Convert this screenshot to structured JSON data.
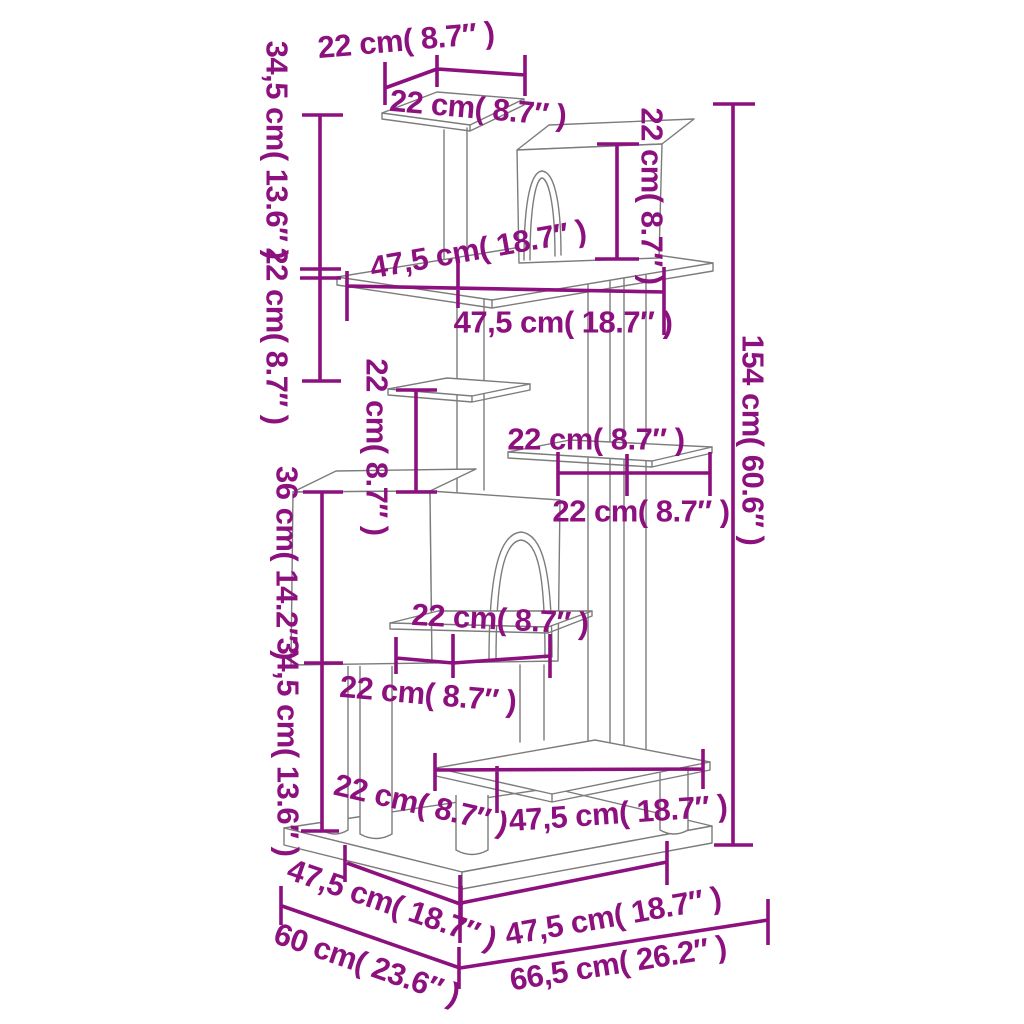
{
  "diagram": {
    "accent_color": "#8c117f",
    "line_color": "#7c7c7c",
    "background_color": "#ffffff",
    "labels": [
      {
        "id": "top-depth-22",
        "text": "22 cm( 8.7″ )",
        "x": 406,
        "y": 40,
        "rot": -5
      },
      {
        "id": "top-width-22",
        "text": "22 cm( 8.7″ )",
        "x": 478,
        "y": 108,
        "rot": 5
      },
      {
        "id": "left-upper-345",
        "text": "34,5 cm( 13.6″ )",
        "x": 277,
        "y": 150,
        "rot": 90
      },
      {
        "id": "left-upper-22",
        "text": "22 cm( 8.7″ )",
        "x": 277,
        "y": 336,
        "rot": 90
      },
      {
        "id": "house1-height-22",
        "text": "22 cm( 8.7″ )",
        "x": 652,
        "y": 196,
        "rot": 90
      },
      {
        "id": "total-height-154",
        "text": "154 cm( 60.6″ )",
        "x": 753,
        "y": 440,
        "rot": 90
      },
      {
        "id": "plat2-depth-475",
        "text": "47,5 cm( 18.7″ )",
        "x": 478,
        "y": 249,
        "rot": -10
      },
      {
        "id": "plat2-width-475",
        "text": "47,5 cm( 18.7″ )",
        "x": 563,
        "y": 322,
        "rot": 0
      },
      {
        "id": "gap-height-22",
        "text": "22 cm( 8.7″ )",
        "x": 377,
        "y": 447,
        "rot": 90
      },
      {
        "id": "shelfR-depth-22",
        "text": "22 cm( 8.7″ )",
        "x": 596,
        "y": 439,
        "rot": 0
      },
      {
        "id": "shelfR-width-22",
        "text": "22 cm( 8.7″ )",
        "x": 641,
        "y": 511,
        "rot": 0
      },
      {
        "id": "house2-height-36",
        "text": "36 cm( 14.2″ )",
        "x": 287,
        "y": 563,
        "rot": 90
      },
      {
        "id": "shelf5-depth-22",
        "text": "22 cm( 8.7″ )",
        "x": 500,
        "y": 619,
        "rot": 3
      },
      {
        "id": "left-lower-345",
        "text": "34,5 cm( 13.6″ )",
        "x": 288,
        "y": 747,
        "rot": 90
      },
      {
        "id": "shelf5-width-22",
        "text": "22 cm( 8.7″ )",
        "x": 428,
        "y": 694,
        "rot": 5
      },
      {
        "id": "base-left-22",
        "text": "22 cm( 8.7″ )",
        "x": 421,
        "y": 804,
        "rot": 13
      },
      {
        "id": "plat6-width-475",
        "text": "47,5 cm( 18.7″ )",
        "x": 618,
        "y": 813,
        "rot": -4
      },
      {
        "id": "baseL-depth-475",
        "text": "47,5 cm( 18.7″ )",
        "x": 392,
        "y": 904,
        "rot": 19
      },
      {
        "id": "baseC-width-475",
        "text": "47,5 cm( 18.7″ )",
        "x": 613,
        "y": 916,
        "rot": -10
      },
      {
        "id": "base-depth-60",
        "text": "60 cm( 23.6″ )",
        "x": 367,
        "y": 964,
        "rot": 19
      },
      {
        "id": "base-width-665",
        "text": "66,5 cm( 26.2″ )",
        "x": 618,
        "y": 963,
        "rot": -9
      }
    ]
  }
}
